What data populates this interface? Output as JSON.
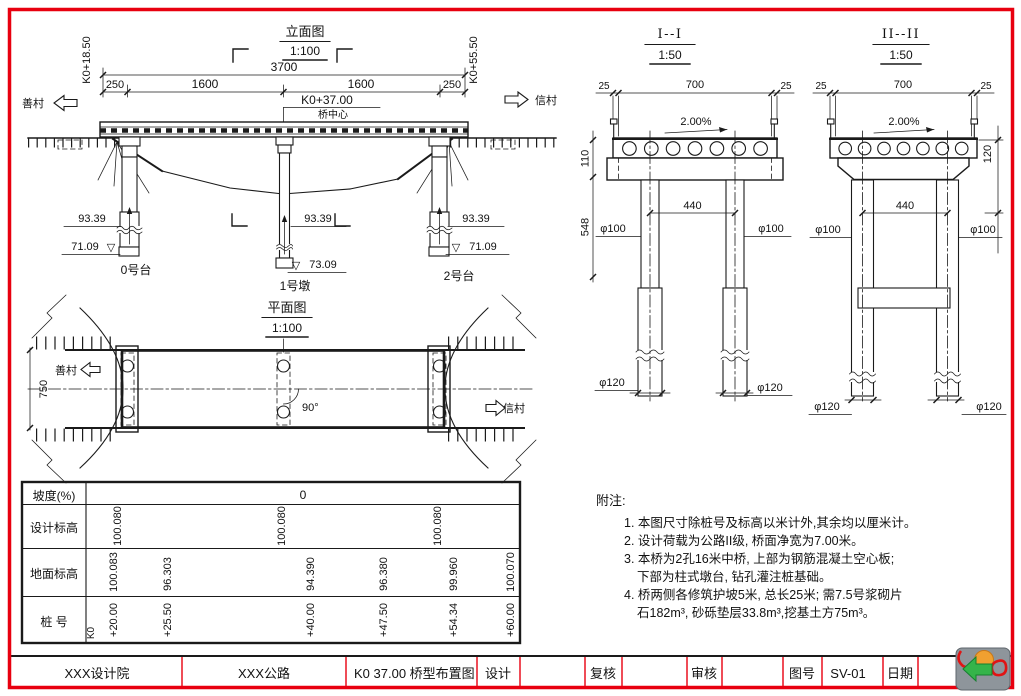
{
  "frame": {
    "border_color": "#e8000f"
  },
  "elevation": {
    "title": "立面图",
    "scale": "1:100",
    "total_dim": "3700",
    "seg_dims": [
      "250",
      "1600",
      "1600",
      "250"
    ],
    "center_station": "K0+37.00",
    "center_label": "桥中心",
    "start_station": "K0+18.50",
    "end_station": "K0+55.50",
    "left_place": "善村",
    "right_place": "信村",
    "pile_top_elev": [
      "93.39",
      "93.39",
      "93.39"
    ],
    "base_elev": [
      "71.09",
      "73.09",
      "71.09"
    ],
    "elev_mark": "▽",
    "supports": [
      "0号台",
      "1号墩",
      "2号台"
    ]
  },
  "plan": {
    "title": "平面图",
    "scale": "1:100",
    "left_place": "善村",
    "right_place": "信村",
    "road_width": "750",
    "skew": "90°"
  },
  "sections": {
    "s1": {
      "title": "I--I",
      "scale": "1:50",
      "edge_l": "25",
      "clear": "700",
      "edge_r": "25",
      "slope": "2.00%",
      "h1": "110",
      "h2": "548",
      "spacing": "440",
      "col_dia": "φ100",
      "pile_dia": "φ120"
    },
    "s2": {
      "title": "II--II",
      "scale": "1:50",
      "edge_l": "25",
      "clear": "700",
      "edge_r": "25",
      "slope": "2.00%",
      "h1": "120",
      "spacing": "440",
      "col_dia": "φ100",
      "pile_dia": "φ120"
    }
  },
  "table": {
    "slope_label": "坡度(%)",
    "slope_value": "0",
    "design_label": "设计标高",
    "design_values": [
      "100.080",
      "100.080",
      "100.080"
    ],
    "ground_label": "地面标高",
    "ground_values": [
      "100.083",
      "96.303",
      "94.390",
      "96.380",
      "99.960",
      "100.070"
    ],
    "stake_label": "桩    号",
    "stake_prefix": "K0",
    "stake_values": [
      "+20.00",
      "+25.50",
      "+40.00",
      "+47.50",
      "+54.34",
      "+60.00"
    ]
  },
  "notes": {
    "title": "附注:",
    "lines": [
      "1. 本图尺寸除桩号及标高以米计外,其余均以厘米计。",
      "2. 设计荷载为公路II级, 桥面净宽为7.00米。",
      "3. 本桥为2孔16米中桥, 上部为钢筋混凝土空心板;",
      "下部为柱式墩台, 钻孔灌注桩基础。",
      "4. 桥两侧各修筑护坡5米, 总长25米; 需7.5号浆砌片",
      "石182m³, 砂砾垫层33.8m³,挖基土方75m³。"
    ]
  },
  "titleblock": {
    "org": "XXX设计院",
    "project": "XXX公路",
    "title": "K0  37.00 桥型布置图",
    "design": "设计",
    "check": "复核",
    "review": "审核",
    "sheet_label": "图号",
    "sheet_no": "SV-01",
    "date_label": "日期"
  }
}
